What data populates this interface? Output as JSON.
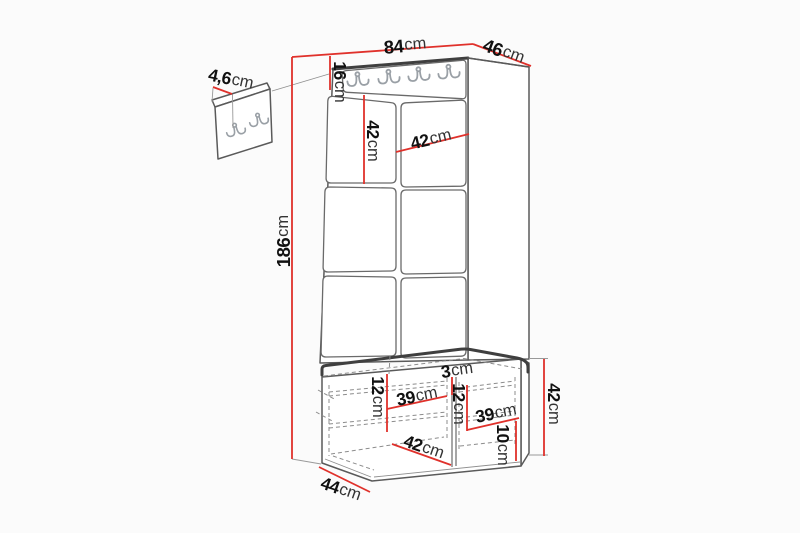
{
  "meta": {
    "description": "Dimension diagram of a hallway furniture set: wall hook panel, tall padded panel unit with coat-hook rail, and a two-compartment shoe bench with cushions",
    "background": "#fbfbfb"
  },
  "colors": {
    "dimension_red": "#e0312b",
    "outline": "#5a5a5a",
    "outline_dark": "#3f3f3f",
    "hooks": "#9aa0a6",
    "dashes": "#8c8c8c",
    "number_text": "#111111",
    "unit_text": "#333333"
  },
  "dims": {
    "width_total": {
      "value": "84",
      "unit": "cm"
    },
    "depth_top": {
      "value": "46",
      "unit": "cm"
    },
    "rail_height": {
      "value": "16",
      "unit": "cm"
    },
    "left_panel_height": {
      "value": "42",
      "unit": "cm"
    },
    "panel_width": {
      "value": "42",
      "unit": "cm"
    },
    "total_height": {
      "value": "186",
      "unit": "cm"
    },
    "wall_panel_thickness": {
      "value": "4,6",
      "unit": "cm"
    },
    "cushion_thickness": {
      "value": "3",
      "unit": "cm"
    },
    "shelf_spacing_left": {
      "value": "12",
      "unit": "cm"
    },
    "compartment_width_left": {
      "value": "39",
      "unit": "cm"
    },
    "shelf_spacing_right": {
      "value": "12",
      "unit": "cm"
    },
    "compartment_width_right": {
      "value": "39",
      "unit": "cm"
    },
    "bench_inner_width": {
      "value": "42",
      "unit": "cm"
    },
    "plinth_height": {
      "value": "10",
      "unit": "cm"
    },
    "bench_height": {
      "value": "42",
      "unit": "cm"
    },
    "bench_depth": {
      "value": "44",
      "unit": "cm"
    }
  }
}
